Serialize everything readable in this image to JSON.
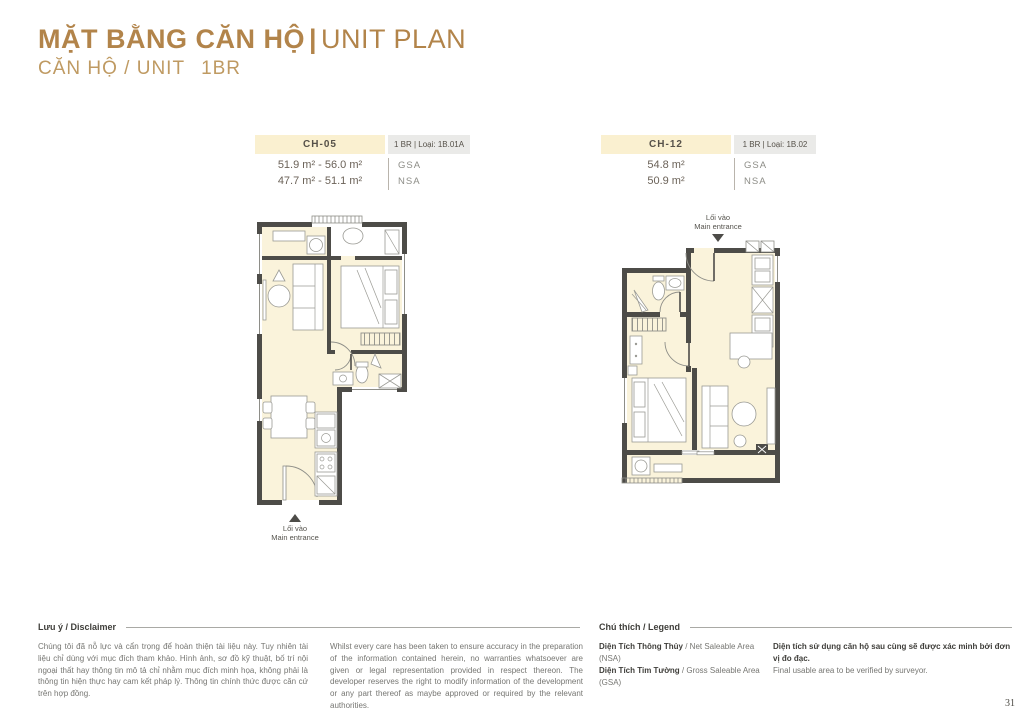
{
  "page": {
    "title_vn": "MẶT BẰNG CĂN HỘ",
    "title_bar": "|",
    "title_en": "UNIT PLAN",
    "subtitle": "CĂN HỘ / UNIT",
    "subtitle_type": "1BR",
    "page_number": "31"
  },
  "colors": {
    "accent_gold": "#b2844a",
    "subtitle_gold": "#bf9a62",
    "unit_code_bg": "#faf0d0",
    "unit_type_bg": "#eaeae8",
    "plan_floor": "#faf3db",
    "plan_wall": "#4d4c48"
  },
  "units": [
    {
      "code": "CH-05",
      "type_label": "1 BR | Loại: 1B.01A",
      "gsa_value": "51.9 m² - 56.0 m²",
      "nsa_value": "47.7 m² - 51.1 m²",
      "gsa_label": "GSA",
      "nsa_label": "NSA",
      "entrance_vn": "Lối vào",
      "entrance_en": "Main entrance"
    },
    {
      "code": "CH-12",
      "type_label": "1 BR | Loại: 1B.02",
      "gsa_value": "54.8 m²",
      "nsa_value": "50.9 m²",
      "gsa_label": "GSA",
      "nsa_label": "NSA",
      "entrance_vn": "Lối vào",
      "entrance_en": "Main entrance"
    }
  ],
  "disclaimer": {
    "heading": "Lưu ý / Disclaimer",
    "text_vn": "Chúng tôi đã nỗ lực và cẩn trọng để hoàn thiện tài liệu này. Tuy nhiên tài liệu chỉ dùng với mục đích tham khảo. Hình ảnh, sơ đồ kỹ thuật, bố trí nội ngoại thất hay thông tin mô tả chỉ nhằm mục đích minh họa, không phải là thông tin hiện thực hay cam kết pháp lý. Thông tin chính thức được căn cứ trên hợp đồng.",
    "text_en": "Whilst every care has been taken to ensure accuracy in the preparation of the information contained herein, no warranties whatsoever are given or legal representation provided in respect thereon. The developer reserves the right to modify information of the development or any part thereof as maybe approved or required by the relevant authorities."
  },
  "legend": {
    "heading": "Chú thích / Legend",
    "items": [
      {
        "bold": "Diện Tích Thông Thủy",
        "rest": " / Net Saleable Area (NSA)"
      },
      {
        "bold": "Diện Tích Tim Tường",
        "rest": " / Gross Saleable Area (GSA)"
      }
    ],
    "note_bold": "Diện tích sử dụng căn hộ sau cùng sẽ được xác minh bởi đơn vị đo đạc.",
    "note_rest": "Final usable area to be verified by surveyor."
  }
}
